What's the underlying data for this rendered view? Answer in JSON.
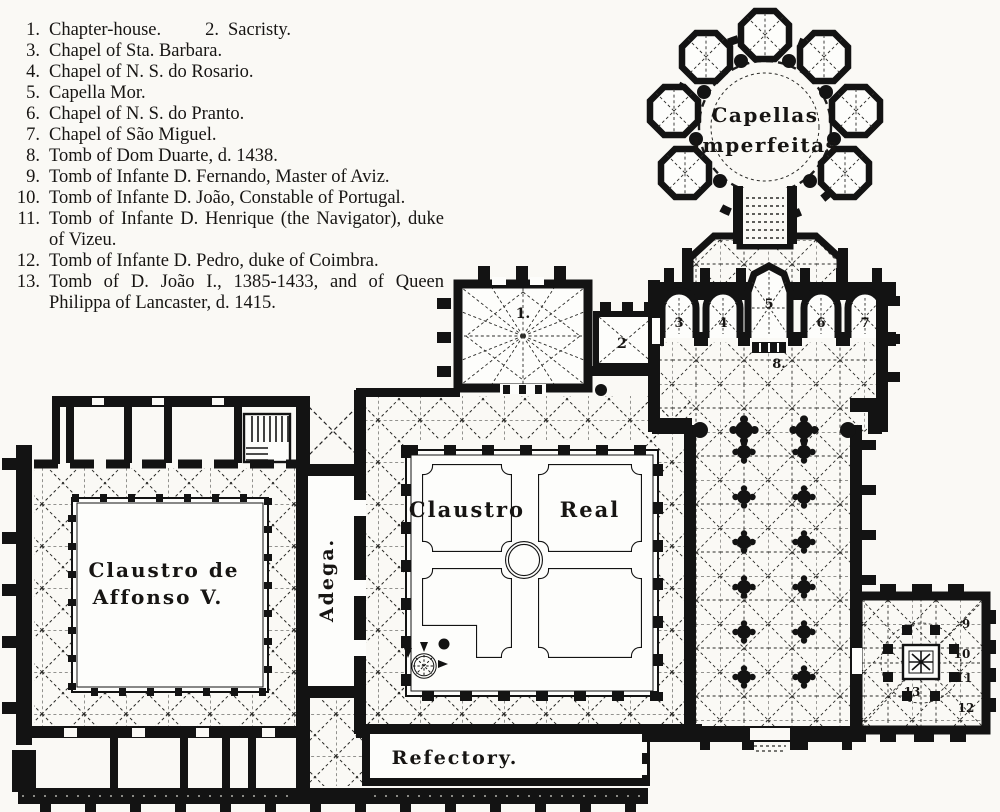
{
  "page": {
    "background": "#faf9f5",
    "ink": "#171513"
  },
  "legend": {
    "rows": [
      {
        "num": "1.",
        "text": "Chapter-house.",
        "num2": "2.",
        "text2": "Sacristy."
      },
      {
        "num": "3.",
        "text": "Chapel of Sta. Barbara."
      },
      {
        "num": "4.",
        "text": "Chapel of N. S. do Rosario."
      },
      {
        "num": "5.",
        "text": "Capella Mor."
      },
      {
        "num": "6.",
        "text": "Chapel of N. S. do Pranto."
      },
      {
        "num": "7.",
        "text": "Chapel of São Miguel."
      },
      {
        "num": "8.",
        "text": "Tomb of Dom Duarte, d. 1438."
      },
      {
        "num": "9.",
        "text": "Tomb of Infante D. Fernando, Master of Aviz."
      },
      {
        "num": "10.",
        "text": "Tomb of Infante D. João, Constable of Portugal."
      },
      {
        "num": "11.",
        "text": "Tomb of Infante D. Henrique (the Navigator), duke of Vizeu."
      },
      {
        "num": "12.",
        "text": "Tomb of Infante D. Pedro, duke of Coimbra."
      },
      {
        "num": "13.",
        "text": "Tomb of D. João I., 1385-1433, and of Queen Philippa of Lancaster, d. 1415."
      }
    ]
  },
  "plan": {
    "labels": {
      "rotunda1": "Capellas",
      "rotunda2": "Imperfeitas",
      "claustro": "Claustro",
      "real": "Real",
      "affonso1": "Claustro de",
      "affonso2": "Affonso V.",
      "adega": "Adega.",
      "refectory": "Refectory."
    },
    "numbers": {
      "n1": "1.",
      "n2": "2",
      "n3": "3",
      "n4": "4",
      "n5": "5",
      "n6": "6",
      "n7": "7",
      "n8": "8.",
      "n9": "9",
      "n10": "10",
      "n11": "11",
      "n12": "12",
      "n13": "13"
    }
  }
}
